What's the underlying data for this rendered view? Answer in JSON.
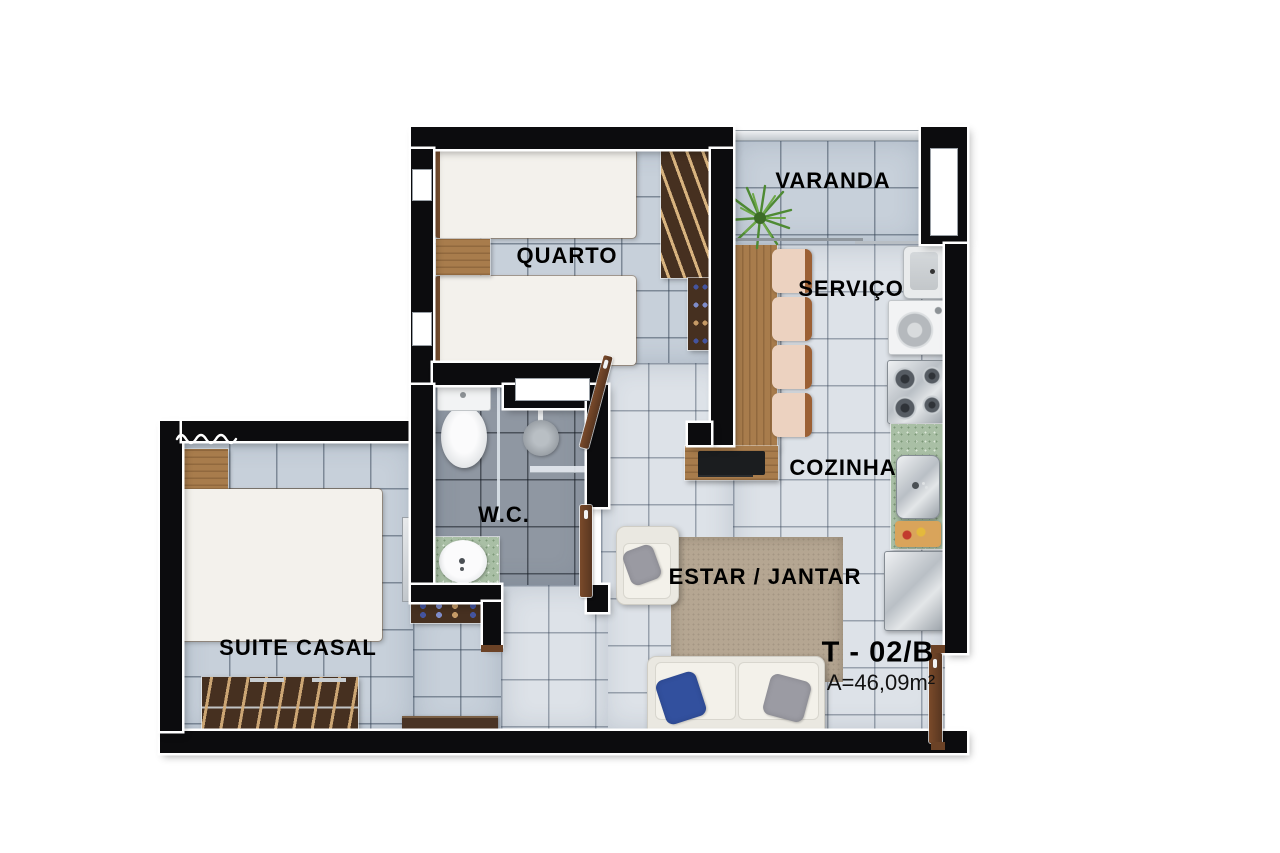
{
  "plan": {
    "rooms": {
      "quarto": "QUARTO",
      "varanda": "VARANDA",
      "servico": "SERVIÇO",
      "cozinha": "COZINHA",
      "wc": "W.C.",
      "estar_jantar": "ESTAR / JANTAR",
      "suite_casal": "SUITE CASAL"
    },
    "unit": {
      "code": "T - 02/B",
      "area": "A=46,09m²"
    },
    "colors": {
      "wall": "#0c0c0e",
      "floor_tile_blue": "#c7d0da",
      "floor_tile_light": "#dde2e8",
      "floor_tile_wc": "#8f97a2",
      "wood_light": "#a87c4c",
      "wood_dark": "#463020",
      "counter_green": "#a9bfa5",
      "door_brown": "#6b4226",
      "pillow_blue": "#32509e",
      "rug_beige": "#b5a692",
      "plant_green": "#4e8a33"
    }
  }
}
